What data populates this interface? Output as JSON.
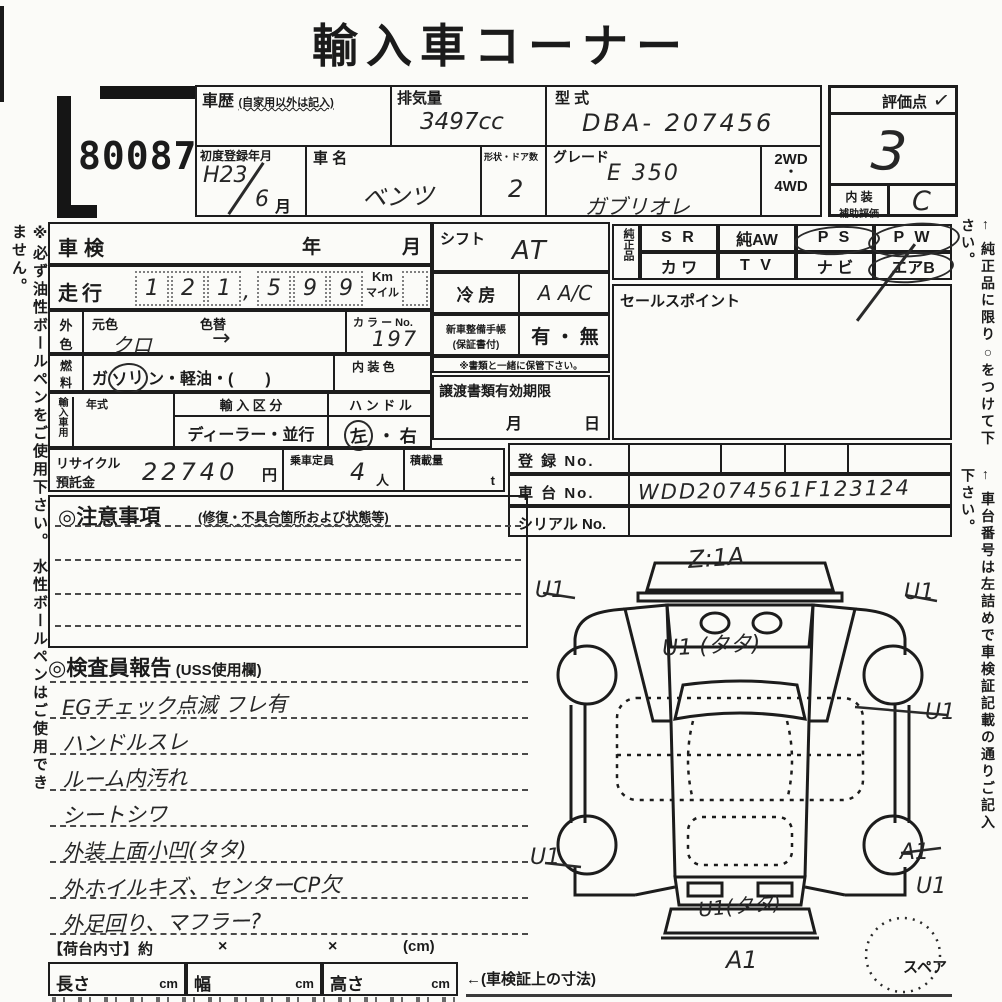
{
  "title": "輸入車コーナー",
  "lot_number": "80087",
  "margin_notes": {
    "left": "※必ず油性ボールペンをご使用下さい。 水性ボールペンはご使用できません。",
    "right_top": "← 純正品に限り○をつけて下さい。",
    "right_bottom": "← 車台番号は左詰めで車検証記載の通りご記入下さい。"
  },
  "header": {
    "history_label": "車歴",
    "history_note": "(自家用以外は記入)",
    "displacement_label": "排気量",
    "displacement_value": "3497cc",
    "model_code_label": "型 式",
    "model_code_value": "DBA- 207456",
    "first_reg_label": "初度登録年月",
    "first_reg_year": "H23",
    "first_reg_month_digit": "6",
    "first_reg_month_label": "月",
    "car_name_label": "車 名",
    "car_name_value": "ベンツ",
    "body_doors_label": "形状・ドア数",
    "body_doors_value": "2",
    "grade_label": "グレード",
    "grade_line1": "E 350",
    "grade_line2": "ガブリオレ",
    "drive_2wd": "2WD",
    "drive_dot": "・",
    "drive_4wd": "4WD"
  },
  "score": {
    "label": "評価点",
    "check": "✓",
    "value": "3",
    "interior_label_1": "内 装",
    "interior_label_2": "補助評価",
    "interior_value": "C"
  },
  "vehicle": {
    "shaken_label": "車検",
    "shaken_year": "年",
    "shaken_month": "月",
    "mileage_label": "走行",
    "mileage_digits": [
      "1",
      "2",
      "1",
      ",",
      "5",
      "9",
      "9"
    ],
    "mileage_unit_top": "Km",
    "mileage_unit_bottom": "マイル",
    "color_label_1": "外",
    "color_label_2": "色",
    "orig_color_label": "元色",
    "orig_color_value": "クロ",
    "color_change_label": "色替",
    "color_change_value": "→",
    "color_no_label": "カ ラ ー No.",
    "color_no_value": "197",
    "fuel_label_1": "燃",
    "fuel_label_2": "料",
    "fuel_pre": "ガ",
    "fuel_circled": "ソリ",
    "fuel_post": "ン・軽油・(",
    "fuel_close": "　　)",
    "interior_color_label": "内 装 色",
    "import_label": "輸入車用",
    "import_year_label": "年式",
    "import_division_label": "輸 入 区 分",
    "import_division_value": "ディーラー・並行",
    "handle_label": "ハ ン ド ル",
    "handle_left": "左",
    "handle_dot": "・",
    "handle_right": "右",
    "recycle_label_1": "リサイクル",
    "recycle_label_2": "預託金",
    "recycle_value": "22740",
    "recycle_unit": "円",
    "capacity_label": "乗車定員",
    "capacity_value": "4",
    "capacity_unit": "人",
    "load_label": "積載量",
    "load_unit": "t"
  },
  "equipment": {
    "shift_label": "シフト",
    "shift_value": "AT",
    "ac_label": "冷 房",
    "ac_value": "A A/C",
    "booklet_label_1": "新車整備手帳",
    "booklet_label_2": "(保証書付)",
    "booklet_value": "有 ・ 無",
    "keep_note": "※書類と一緒に保管下さい。",
    "transfer_label": "譲渡書類有効期限",
    "transfer_month": "月",
    "transfer_day": "日"
  },
  "genuine": {
    "label": "純正品",
    "row1": [
      "S R",
      "純AW",
      "P S",
      "P W"
    ],
    "row2": [
      "カ ワ",
      "T V",
      "ナ ビ",
      "エアB"
    ]
  },
  "sales_point_label": "セールスポイント",
  "registration": {
    "reg_label": "登 録 No.",
    "chassis_label": "車 台 No.",
    "chassis_value": "WDD2074561F123124",
    "serial_label": "シリアル No."
  },
  "notes": {
    "title": "◎注意事項",
    "subtitle": "(修復・不具合箇所および状態等)"
  },
  "inspector": {
    "title": "◎検査員報告",
    "subtitle": "(USS使用欄)",
    "lines": [
      "EGチェック点滅 フレ有",
      "ハンドルスレ",
      "ルーム内汚れ",
      "シートシワ",
      "外装上面小凹(タタ)",
      "外ホイルキズ、センターCP欠",
      "外足回り、マフラー?"
    ]
  },
  "cargo": {
    "label": "【荷台内寸】約",
    "times_1": "×",
    "times_2": "×",
    "unit": "(cm)"
  },
  "dimensions": {
    "length_label": "長さ",
    "width_label": "幅",
    "height_label": "高さ",
    "unit": "cm",
    "note": "←(車検証上の寸法)"
  },
  "diagram": {
    "mark_top": "Z:1A",
    "mark_front_left": "U1",
    "mark_front_right": "U1",
    "mark_windshield": "U1 (タタ)",
    "mark_side_right": "U1",
    "mark_rear_left": "U1",
    "mark_rear_right_a": "A1",
    "mark_rear_right_u": "U1",
    "mark_trunk": "U1(タタ)",
    "mark_bottom": "A1",
    "spare_label": "スペア"
  }
}
